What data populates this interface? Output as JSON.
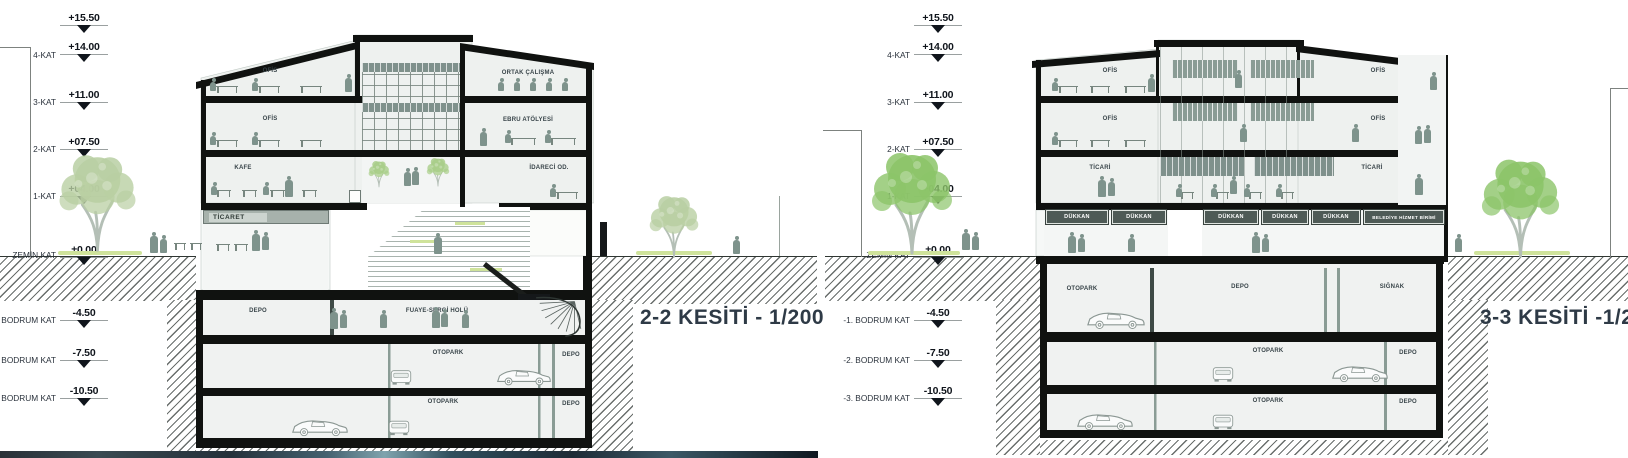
{
  "sheet": {
    "left": {
      "title": "2-2 KESİTİ - 1/200",
      "rooms": {
        "ofis_3": "OFİS",
        "ofis_2": "OFİS",
        "kafe": "KAFE",
        "ticaret": "TİCARET",
        "ortak_calisma": "ORTAK ÇALIŞMA",
        "ebru_atolyesi": "EBRU ATÖLYESİ",
        "idareci_od": "İDARECİ OD.",
        "depo_b1": "DEPO",
        "fuaye": "FUAYE-SERGİ HOLÜ",
        "otopark_b2": "OTOPARK",
        "depo_b2": "DEPO",
        "otopark_b3": "OTOPARK",
        "depo_b3": "DEPO"
      }
    },
    "right": {
      "title": "3-3 KESİTİ -1/200",
      "rooms": {
        "ofis_l3": "OFİS",
        "ofis_l2": "OFİS",
        "ticari_l": "TİCARİ",
        "ofis_r3": "OFİS",
        "ofis_r2": "OFİS",
        "ticari_r": "TİCARİ",
        "belediye": "BELEDİYE HİZMET BİRİMİ",
        "otopark_b1": "OTOPARK",
        "depo_b1": "DEPO",
        "siginak": "SIĞNAK",
        "otopark_b2": "OTOPARK",
        "depo_b2": "DEPO",
        "otopark_b3": "OTOPARK",
        "depo_b3": "DEPO"
      },
      "shops": [
        "DÜKKAN",
        "DÜKKAN",
        "DÜKKAN",
        "DÜKKAN",
        "DÜKKAN"
      ]
    },
    "levels": [
      {
        "label": "",
        "value": "+15.50"
      },
      {
        "label": "4-KAT",
        "value": "+14.00"
      },
      {
        "label": "3-KAT",
        "value": "+11.00"
      },
      {
        "label": "2-KAT",
        "value": "+07.50"
      },
      {
        "label": "1-KAT",
        "value": "+04.00"
      },
      {
        "label": "ZEMİN KAT",
        "value": "±0.00"
      },
      {
        "label": "-1. BODRUM KAT",
        "value": "-4.50"
      },
      {
        "label": "-2. BODRUM KAT",
        "value": "-7.50"
      },
      {
        "label": "-3. BODRUM KAT",
        "value": "-10.50"
      }
    ],
    "colors": {
      "slab": "#111111",
      "tree_pale": "#b9cfa3",
      "tree_green": "#8cc469",
      "figure": "#7e938c",
      "glass_mullion": "#7a8680",
      "sign_dark": "#4e5a56",
      "hatch_line": "#696e6c",
      "title_text": "#2e3a46",
      "grass": "#cfe39b"
    }
  }
}
